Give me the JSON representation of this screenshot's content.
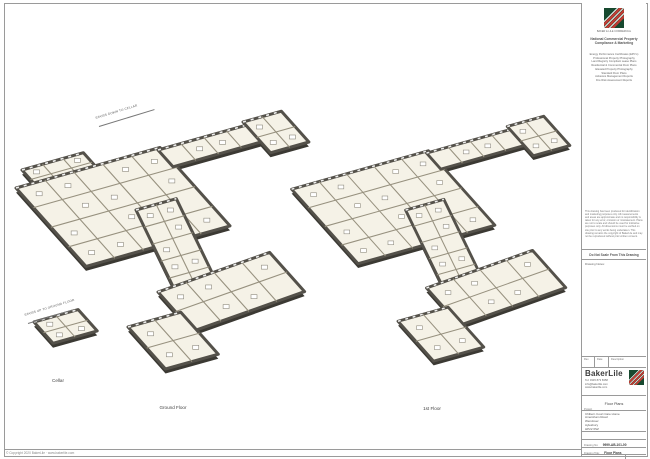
{
  "panel": {
    "logo_caption": "BAKER & LILE COMMERCIAL",
    "heading_line1": "National Commercial Property",
    "heading_line2": "Compliance & Marketing",
    "services": [
      "Energy Performance Certificates (EPC's)",
      "Professional Property Photography",
      "Land Registry Compliant Lease Plans",
      "Residential & Commercial Floor Plans",
      "Elevated Property Photography",
      "Standard Floor Plans",
      "Asbestos Management Reports",
      "Fire Risk Assessment Reports"
    ],
    "disclaimer": "This drawing has been produced for identification and marketing purposes only. All measurements and areas are approximate and no responsibility is taken for any error, omission or misstatement. Plans are not to scale and should be used for indicative purposes only. All dimensions must be verified on site prior to any works being undertaken. This drawing remains the copyright of BakerLile and may not be reproduced without prior written consent.",
    "do_not_scale": "Do Not Scale From This Drawing",
    "drawing_notes_label": "Drawing Notes:",
    "rev_table": {
      "rev": "Rev",
      "date": "Date",
      "desc": "Description"
    },
    "brand": {
      "name": "BakerLile",
      "tel": "Tel: 0345 873 8358",
      "email": "info@bakerlile.com",
      "web": "www.bakerlile.com"
    },
    "project_label": "Project",
    "project_value": "Floor Plans",
    "address": [
      "Chiltern Court Care Home",
      "Amersham Road",
      "Wendover",
      "Aylesbury",
      "HP22 6SZ"
    ],
    "rows": {
      "no_label": "Drawing No:",
      "no_value": "9999-AB-101-00",
      "title_label": "Drawing Title:",
      "title_value": "Floor Plans",
      "date_label": "Drawing Date:",
      "date_value": "2020",
      "size_label": "Drawing Size:",
      "size_value": "@A1",
      "rev_label": "Rev",
      "rev_value": "1"
    }
  },
  "plans": {
    "ground_label": "Ground Floor",
    "first_label": "1st Floor",
    "cellar_label": "Cellar",
    "annotation_ground": "STAIRS DOWN TO CELLAR",
    "annotation_cellar": "STAIRS UP TO GROUND FLOOR"
  },
  "page": {
    "copyright": "© Copyright 2020 BakerLile  ·  www.bakerlile.com"
  },
  "colors": {
    "wall": "#54514a",
    "wall_dark": "#3b3933",
    "floor": "#f5f2e7",
    "partition": "#97917f",
    "accent_green": "#17492f",
    "accent_red": "#c23b33"
  }
}
